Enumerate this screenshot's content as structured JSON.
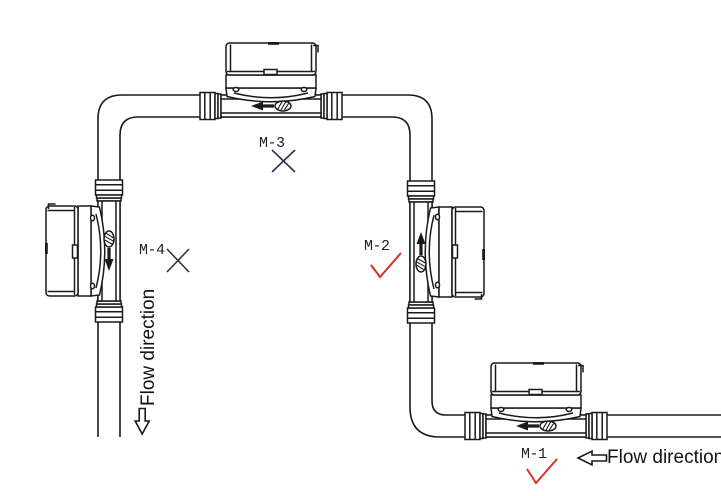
{
  "meters": [
    {
      "label": "M-1",
      "orientation": "horizontal-bottom",
      "mark": "check",
      "status": "correct"
    },
    {
      "label": "M-2",
      "orientation": "vertical-flow-up",
      "mark": "check",
      "status": "correct"
    },
    {
      "label": "M-3",
      "orientation": "horizontal-top",
      "mark": "cross",
      "status": "incorrect"
    },
    {
      "label": "M-4",
      "orientation": "vertical-flow-down",
      "mark": "cross",
      "status": "incorrect"
    }
  ],
  "flow_direction": {
    "left_label": "Flow direction",
    "bottom_label": "Flow direction"
  },
  "icons": {
    "left_arrow": "hollow-left-arrow",
    "down_arrow": "hollow-down-arrow",
    "check_glyph": "√",
    "cross_glyph": "×"
  },
  "colors": {
    "line": "#1a1a1a",
    "check_mark": "#d93025",
    "cross_mark": "#30324a",
    "text": "#141414",
    "background": "#ffffff"
  }
}
